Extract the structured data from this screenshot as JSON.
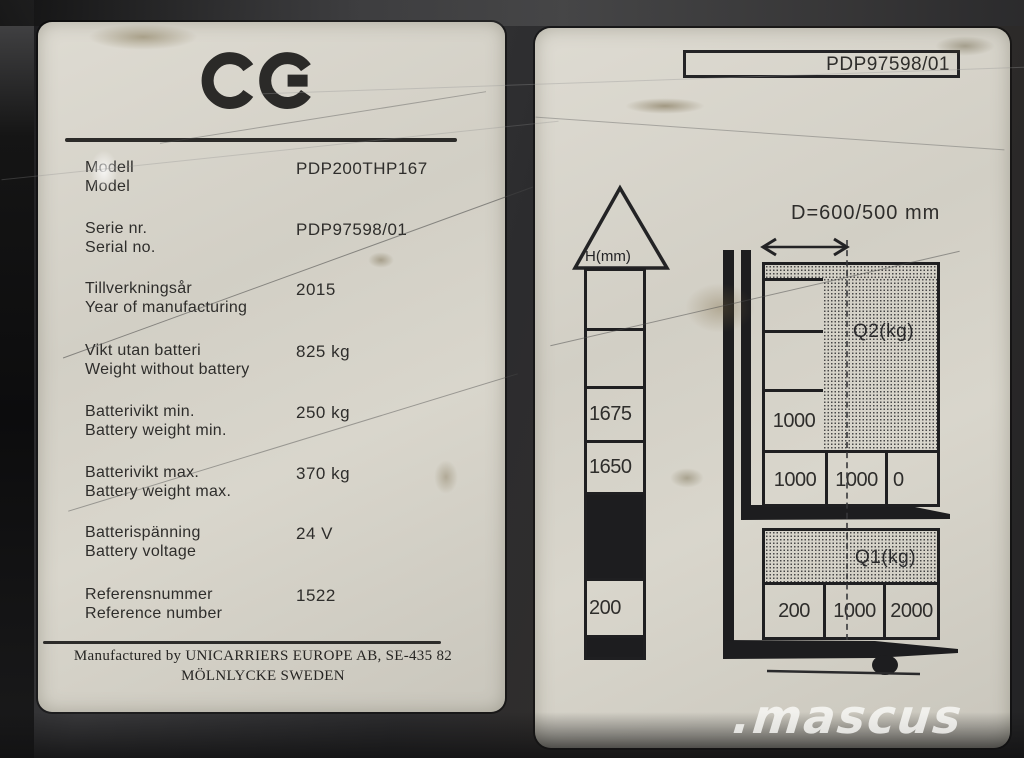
{
  "colors": {
    "plate_background": "#d4d1c8",
    "ink": "#2e2d2b",
    "backdrop": "#2c2c2e",
    "watermark": "#fafaf8"
  },
  "left_label": {
    "ce_mark": "CE",
    "rows": [
      {
        "label_sv": "Modell",
        "label_en": "Model",
        "value": "PDP200THP167"
      },
      {
        "label_sv": "Serie nr.",
        "label_en": "Serial no.",
        "value": "PDP97598/01"
      },
      {
        "label_sv": "Tillverkningsår",
        "label_en": "Year of manufacturing",
        "value": "2015"
      },
      {
        "label_sv": "Vikt utan batteri",
        "label_en": "Weight without battery",
        "value": "825 kg"
      },
      {
        "label_sv": "Batterivikt min.",
        "label_en": "Battery weight min.",
        "value": "250 kg"
      },
      {
        "label_sv": "Batterivikt max.",
        "label_en": "Battery weight max.",
        "value": "370 kg"
      },
      {
        "label_sv": "Batterispänning",
        "label_en": "Battery voltage",
        "value": "24 V"
      },
      {
        "label_sv": "Referensnummer",
        "label_en": "Reference number",
        "value": "1522"
      }
    ],
    "manufacturer_line1": "Manufactured by UNICARRIERS EUROPE AB,  SE-435 82",
    "manufacturer_line2": "MÖLNLYCKE SWEDEN"
  },
  "right_label": {
    "serial_box": "PDP97598/01",
    "dimension_label": "D=600/500 mm",
    "height_scale": {
      "title": "H(mm)",
      "cells": [
        "",
        "",
        "1675",
        "1650",
        "",
        "200",
        ""
      ]
    },
    "q2_table": {
      "title": "Q2(kg)",
      "left_column": [
        "",
        "",
        "1000"
      ],
      "bottom_row": [
        "1000",
        "1000",
        "0"
      ]
    },
    "q1_table": {
      "title": "Q1(kg)",
      "bottom_row": [
        "200",
        "1000",
        "2000"
      ]
    }
  },
  "watermark": ".mascus"
}
